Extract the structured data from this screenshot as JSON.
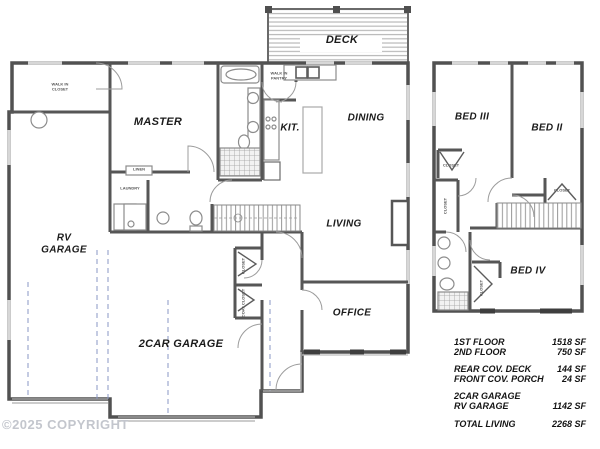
{
  "copyright_notice": "©2025 COPYRIGHT",
  "first_floor": {
    "deck_label": "DECK",
    "master_label": "MASTER",
    "kitchen_label": "KIT.",
    "dining_label": "DINING",
    "living_label": "LIVING",
    "office_label": "OFFICE",
    "rv_garage_label": "RV GARAGE",
    "two_car_garage_label": "2CAR GARAGE",
    "walk_in_closet_label": "WALK IN CLOSET",
    "walk_in_pantry_label": "WALK IN PANTRY",
    "laundry_label": "LAUNDRY",
    "linen_label": "LINEN",
    "closet_label": "CLOSET",
    "coat_closet_label": "COAT CLOSET"
  },
  "second_floor": {
    "bed_iii_label": "BED III",
    "bed_ii_label": "BED II",
    "bed_iv_label": "BED IV",
    "hall_closet_label": "CLOSET",
    "bed_iii_closet_label": "CLOSET",
    "bed_ii_closet_label": "CLOSET",
    "bed_iv_closet_label": "CLOSET"
  },
  "area_table": {
    "rows": [
      {
        "label": "1ST FLOOR",
        "value": "1518 SF"
      },
      {
        "label": "2ND FLOOR",
        "value": "750 SF"
      },
      {
        "label": "REAR COV. DECK",
        "value": "144 SF"
      },
      {
        "label": "FRONT COV. PORCH",
        "value": "24 SF"
      },
      {
        "label": "2CAR GARAGE",
        "value": ""
      },
      {
        "label": "RV GARAGE",
        "value": "1142 SF"
      },
      {
        "label": "TOTAL LIVING",
        "value": "2268 SF"
      }
    ]
  }
}
